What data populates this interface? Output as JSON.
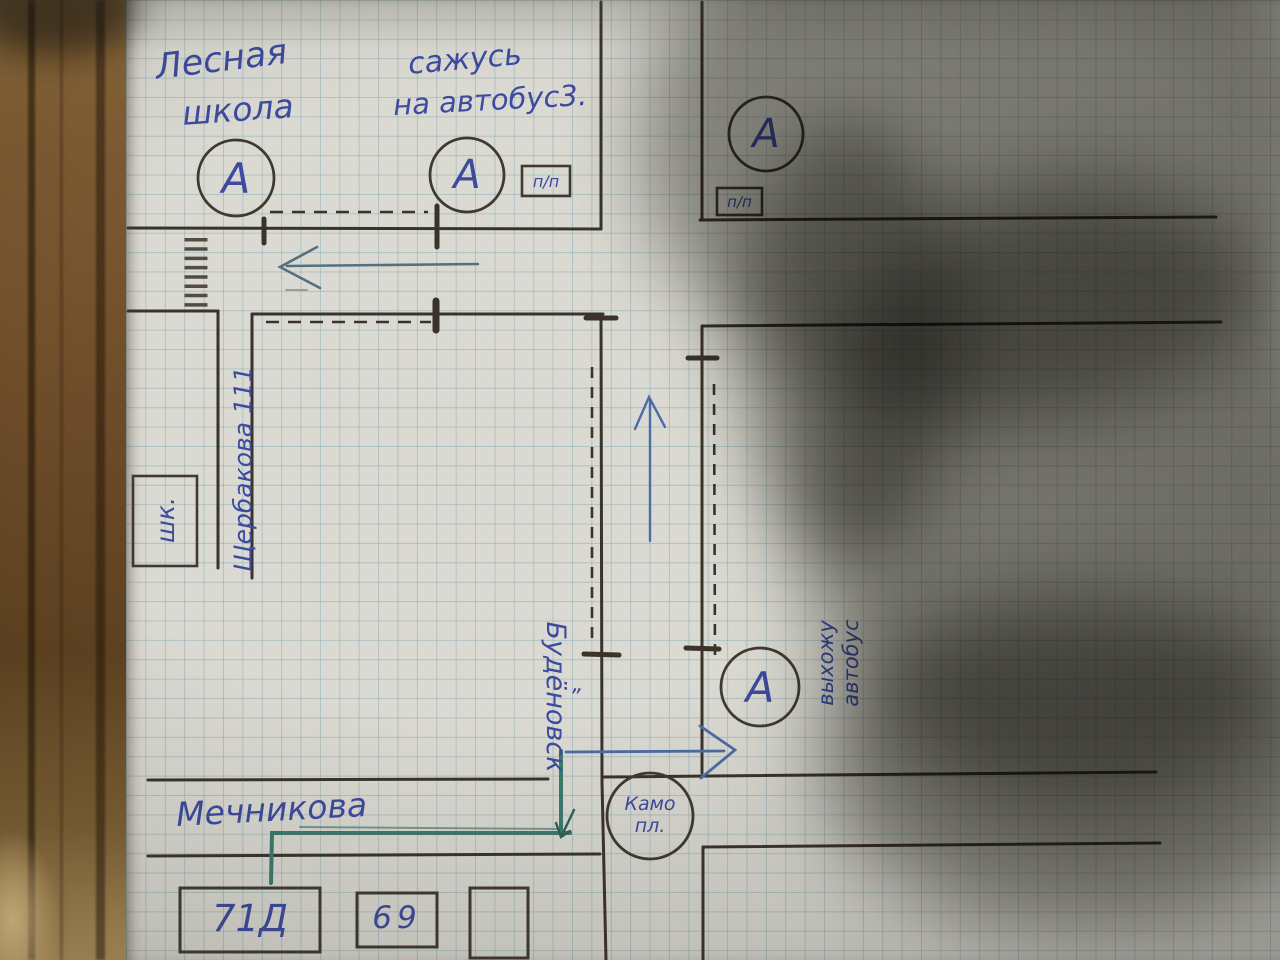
{
  "map": {
    "school_label": {
      "line1": "Лесная",
      "line2": "школа"
    },
    "boarding_note": {
      "line1": "сажусь",
      "line2": "на автобус3."
    },
    "bus_stop_letter": "А",
    "crossing_label": "п/п",
    "streets": {
      "shcherbakova": "Щербакова 111",
      "budyonovsk": "Будёновск",
      "budyonovsk_quote": "„",
      "mechnikova": "Мечникова"
    },
    "school_box_label": "шк.",
    "square_label": {
      "line1": "Камо",
      "line2": "пл."
    },
    "exit_note": {
      "line1": "выхожу",
      "line2": "автобус"
    },
    "houses": {
      "house1": "71Д",
      "house2": "69"
    }
  },
  "colors": {
    "ink_blue": "#3c4a9f",
    "pencil": "#3a332b",
    "teal_arrow": "#53707e",
    "blue_arrow": "#4c6ca6",
    "route_green": "#3c7a6e",
    "paper": "#dbdad2",
    "grid": "#769eac",
    "wood": "#7d5a32"
  }
}
